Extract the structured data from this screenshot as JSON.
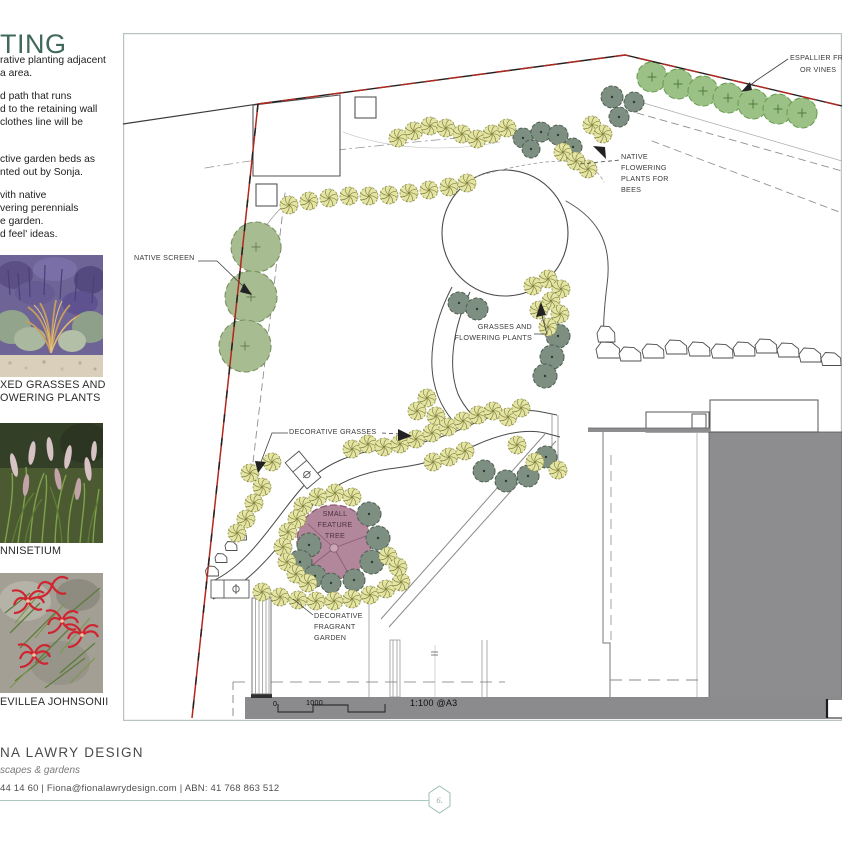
{
  "sidebar": {
    "title": "TING",
    "paragraphs": [
      "rative planting adjacent\na area.",
      "d path that runs\nd to the retaining wall\nclothes line will be",
      "ctive garden beds as\nnted out by Sonja.",
      "vith native\nvering perennials\ne garden.\nd feel' ideas."
    ],
    "photos": [
      {
        "name": "mixed-grasses",
        "caption": "XED GRASSES AND\nOWERING PLANTS"
      },
      {
        "name": "pennisetium",
        "caption": "NNISETIUM"
      },
      {
        "name": "grevillea",
        "caption": "EVILLEA JOHNSONII"
      }
    ]
  },
  "footer": {
    "studio": "NA LAWRY DESIGN",
    "tagline": "scapes & gardens",
    "contact": "44 14 60 | Fiona@fionalawrydesign.com | ABN: 41 768 863 512",
    "page_number": "6."
  },
  "plan": {
    "labels": [
      {
        "id": "native-screen",
        "text": "NATIVE SCREEN",
        "x": 134,
        "y": 252,
        "w": 74
      },
      {
        "id": "bees",
        "text": "NATIVE\nFLOWERING\nPLANTS FOR\nBEES",
        "x": 621,
        "y": 151,
        "w": 58
      },
      {
        "id": "espalier-1",
        "text": "ESPALLIER FR",
        "x": 790,
        "y": 52,
        "w": 70
      },
      {
        "id": "espalier-2",
        "text": "OR VINES",
        "x": 800,
        "y": 64,
        "w": 50
      },
      {
        "id": "grasses-flowering",
        "text": "GRASSES AND\nFLOWERING PLANTS",
        "x": 448,
        "y": 321,
        "w": 84,
        "align": "right"
      },
      {
        "id": "decorative-grasses",
        "text": "DECORATIVE GRASSES",
        "x": 289,
        "y": 426,
        "w": 110
      },
      {
        "id": "feature-tree",
        "text": "SMALL\nFEATURE\nTREE",
        "x": 311,
        "y": 508,
        "w": 48,
        "align": "center",
        "color": "#4e3242"
      },
      {
        "id": "fragrant",
        "text": "DECORATIVE\nFRAGRANT\nGARDEN",
        "x": 314,
        "y": 610,
        "w": 70
      },
      {
        "id": "scale-0",
        "text": "0",
        "x": 273,
        "y": 698,
        "w": 12,
        "color": "#111111"
      },
      {
        "id": "scale-1000",
        "text": "1000",
        "x": 306,
        "y": 697,
        "w": 28,
        "color": "#111111"
      },
      {
        "id": "scale-ratio",
        "text": "1:100 @A3",
        "x": 410,
        "y": 697,
        "w": 64,
        "size": 9,
        "color": "#111111"
      }
    ],
    "colors": {
      "grass_fill": "#e4e4a4",
      "grass_stroke": "#83833e",
      "shrub_fill": "#7d8f81",
      "shrub_stroke": "#4e5e52",
      "screen_fill": "#a8bc92",
      "screen_stroke": "#79915f",
      "espalier_fill": "#9cc186",
      "espalier_stroke": "#6b9e53",
      "feature_fill": "#b2879b",
      "feature_stroke": "#8a5b72",
      "boundary_red": "#b3281e"
    },
    "symbols": {
      "grasses": [
        [
          398,
          138
        ],
        [
          414,
          131
        ],
        [
          430,
          126
        ],
        [
          446,
          128
        ],
        [
          462,
          134
        ],
        [
          477,
          139
        ],
        [
          492,
          134
        ],
        [
          507,
          128
        ],
        [
          563,
          152
        ],
        [
          576,
          161
        ],
        [
          588,
          169
        ],
        [
          592,
          125
        ],
        [
          603,
          134
        ],
        [
          289,
          205
        ],
        [
          309,
          201
        ],
        [
          329,
          198
        ],
        [
          349,
          196
        ],
        [
          369,
          196
        ],
        [
          389,
          195
        ],
        [
          409,
          193
        ],
        [
          429,
          190
        ],
        [
          449,
          187
        ],
        [
          467,
          183
        ],
        [
          533,
          286
        ],
        [
          548,
          279
        ],
        [
          561,
          289
        ],
        [
          551,
          301
        ],
        [
          539,
          310
        ],
        [
          560,
          314
        ],
        [
          548,
          327
        ],
        [
          427,
          398
        ],
        [
          417,
          411
        ],
        [
          436,
          416
        ],
        [
          250,
          473
        ],
        [
          262,
          487
        ],
        [
          254,
          503
        ],
        [
          246,
          519
        ],
        [
          237,
          533
        ],
        [
          272,
          462
        ],
        [
          352,
          449
        ],
        [
          368,
          444
        ],
        [
          384,
          447
        ],
        [
          400,
          444
        ],
        [
          416,
          439
        ],
        [
          432,
          433
        ],
        [
          448,
          427
        ],
        [
          463,
          421
        ],
        [
          478,
          415
        ],
        [
          493,
          411
        ],
        [
          508,
          417
        ],
        [
          521,
          408
        ],
        [
          433,
          462
        ],
        [
          449,
          457
        ],
        [
          465,
          451
        ],
        [
          517,
          445
        ],
        [
          535,
          462
        ],
        [
          558,
          470
        ],
        [
          303,
          506
        ],
        [
          318,
          497
        ],
        [
          335,
          493
        ],
        [
          352,
          497
        ],
        [
          297,
          519
        ],
        [
          288,
          532
        ],
        [
          283,
          547
        ],
        [
          287,
          562
        ],
        [
          296,
          574
        ],
        [
          308,
          583
        ],
        [
          262,
          592
        ],
        [
          280,
          597
        ],
        [
          298,
          600
        ],
        [
          316,
          601
        ],
        [
          334,
          601
        ],
        [
          352,
          599
        ],
        [
          370,
          595
        ],
        [
          386,
          589
        ],
        [
          401,
          582
        ],
        [
          388,
          556
        ],
        [
          398,
          567
        ]
      ],
      "shrubs": [
        [
          523,
          138,
          10
        ],
        [
          541,
          132,
          10
        ],
        [
          558,
          135,
          10
        ],
        [
          531,
          149,
          9
        ],
        [
          573,
          147,
          9
        ],
        [
          612,
          97,
          11
        ],
        [
          634,
          102,
          10
        ],
        [
          619,
          117,
          10
        ],
        [
          459,
          303,
          11
        ],
        [
          477,
          309,
          11
        ],
        [
          558,
          336,
          12
        ],
        [
          552,
          357,
          12
        ],
        [
          545,
          376,
          12
        ],
        [
          484,
          471,
          11
        ],
        [
          506,
          481,
          11
        ],
        [
          528,
          476,
          11
        ],
        [
          546,
          457,
          11
        ],
        [
          369,
          514,
          12
        ],
        [
          378,
          538,
          12
        ],
        [
          372,
          562,
          12
        ],
        [
          354,
          580,
          11
        ],
        [
          309,
          545,
          12
        ],
        [
          300,
          562,
          12
        ],
        [
          315,
          576,
          11
        ],
        [
          331,
          583,
          10
        ]
      ],
      "screen_trees": [
        [
          256,
          247,
          25
        ],
        [
          251,
          297,
          26
        ],
        [
          245,
          346,
          26
        ]
      ],
      "espalier_trees": [
        [
          652,
          77
        ],
        [
          678,
          84
        ],
        [
          703,
          91
        ],
        [
          728,
          98
        ],
        [
          753,
          104
        ],
        [
          778,
          109
        ],
        [
          802,
          113
        ]
      ],
      "espalier_radius": 15,
      "feature_tree": {
        "x": 334,
        "y": 542,
        "r": 37
      },
      "rocks": [
        [
          606,
          334,
          18,
          16
        ],
        [
          608,
          350,
          24,
          16
        ],
        [
          630,
          354,
          22,
          14
        ],
        [
          653,
          351,
          22,
          14
        ],
        [
          676,
          347,
          22,
          14
        ],
        [
          699,
          349,
          22,
          14
        ],
        [
          722,
          351,
          22,
          14
        ],
        [
          744,
          349,
          22,
          14
        ],
        [
          766,
          346,
          22,
          14
        ],
        [
          788,
          350,
          22,
          14
        ],
        [
          810,
          355,
          22,
          14
        ],
        [
          831,
          359,
          20,
          13
        ],
        [
          212,
          571,
          13,
          10
        ],
        [
          221,
          558,
          12,
          9
        ],
        [
          231,
          546,
          12,
          9
        ],
        [
          241,
          536,
          11,
          8
        ]
      ]
    }
  }
}
